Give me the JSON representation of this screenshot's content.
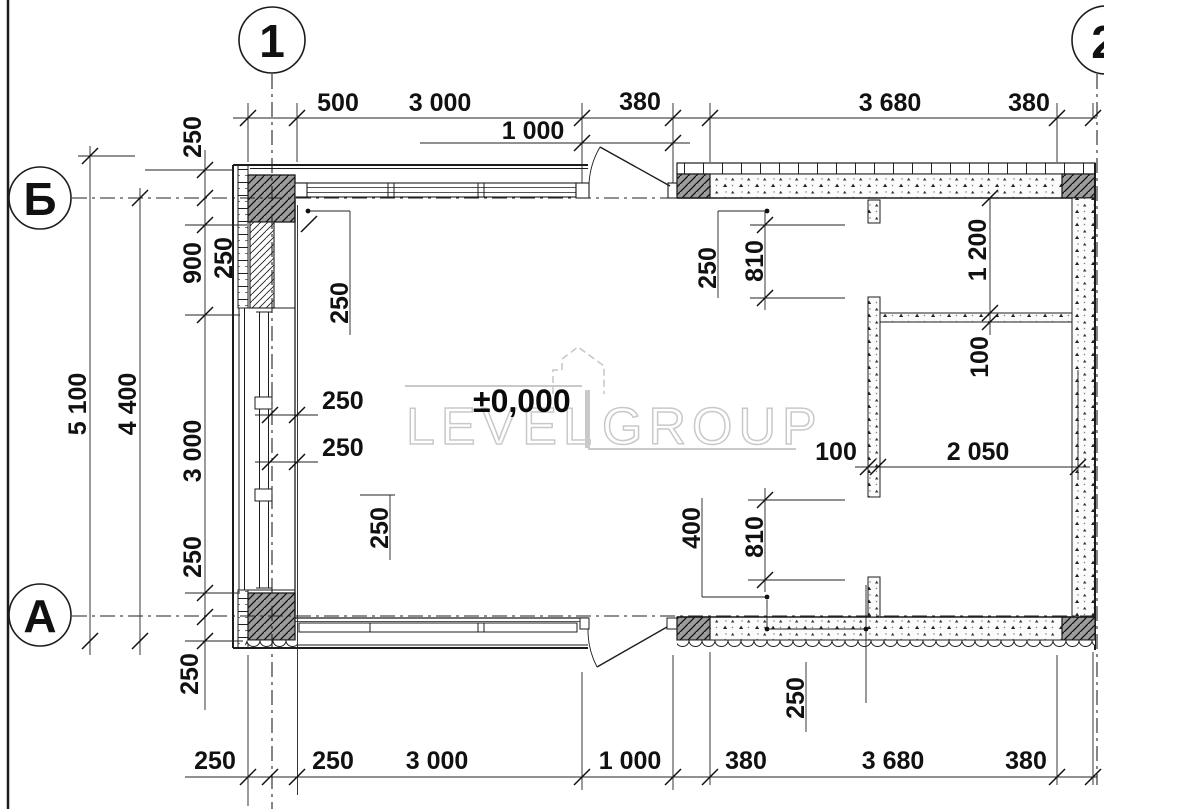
{
  "plan": {
    "level_mark": "±0,000",
    "watermark": {
      "left": "LEVEL",
      "right": "GROUP"
    },
    "grid": {
      "cols": [
        "1",
        "2"
      ],
      "rows": [
        "Б",
        "А"
      ]
    },
    "dims": {
      "top": [
        "500",
        "3 000",
        "380",
        "3 680",
        "380"
      ],
      "top_door": "1 000",
      "bottom": [
        "250",
        "250",
        "3 000",
        "1 000",
        "380",
        "3 680",
        "380"
      ],
      "left": [
        "5 100",
        "4 400",
        "250",
        "250",
        "900",
        "3 000",
        "250",
        "250"
      ],
      "inner_left": [
        "250",
        "250",
        "250",
        "250"
      ],
      "inner_right": [
        "250",
        "810",
        "1 200",
        "100",
        "100",
        "2 050",
        "400",
        "810",
        "250"
      ]
    },
    "colors": {
      "line": "#1c1c1c",
      "hatch_fill": "#9c9c9c",
      "watermark": "#c9c9c9"
    }
  }
}
